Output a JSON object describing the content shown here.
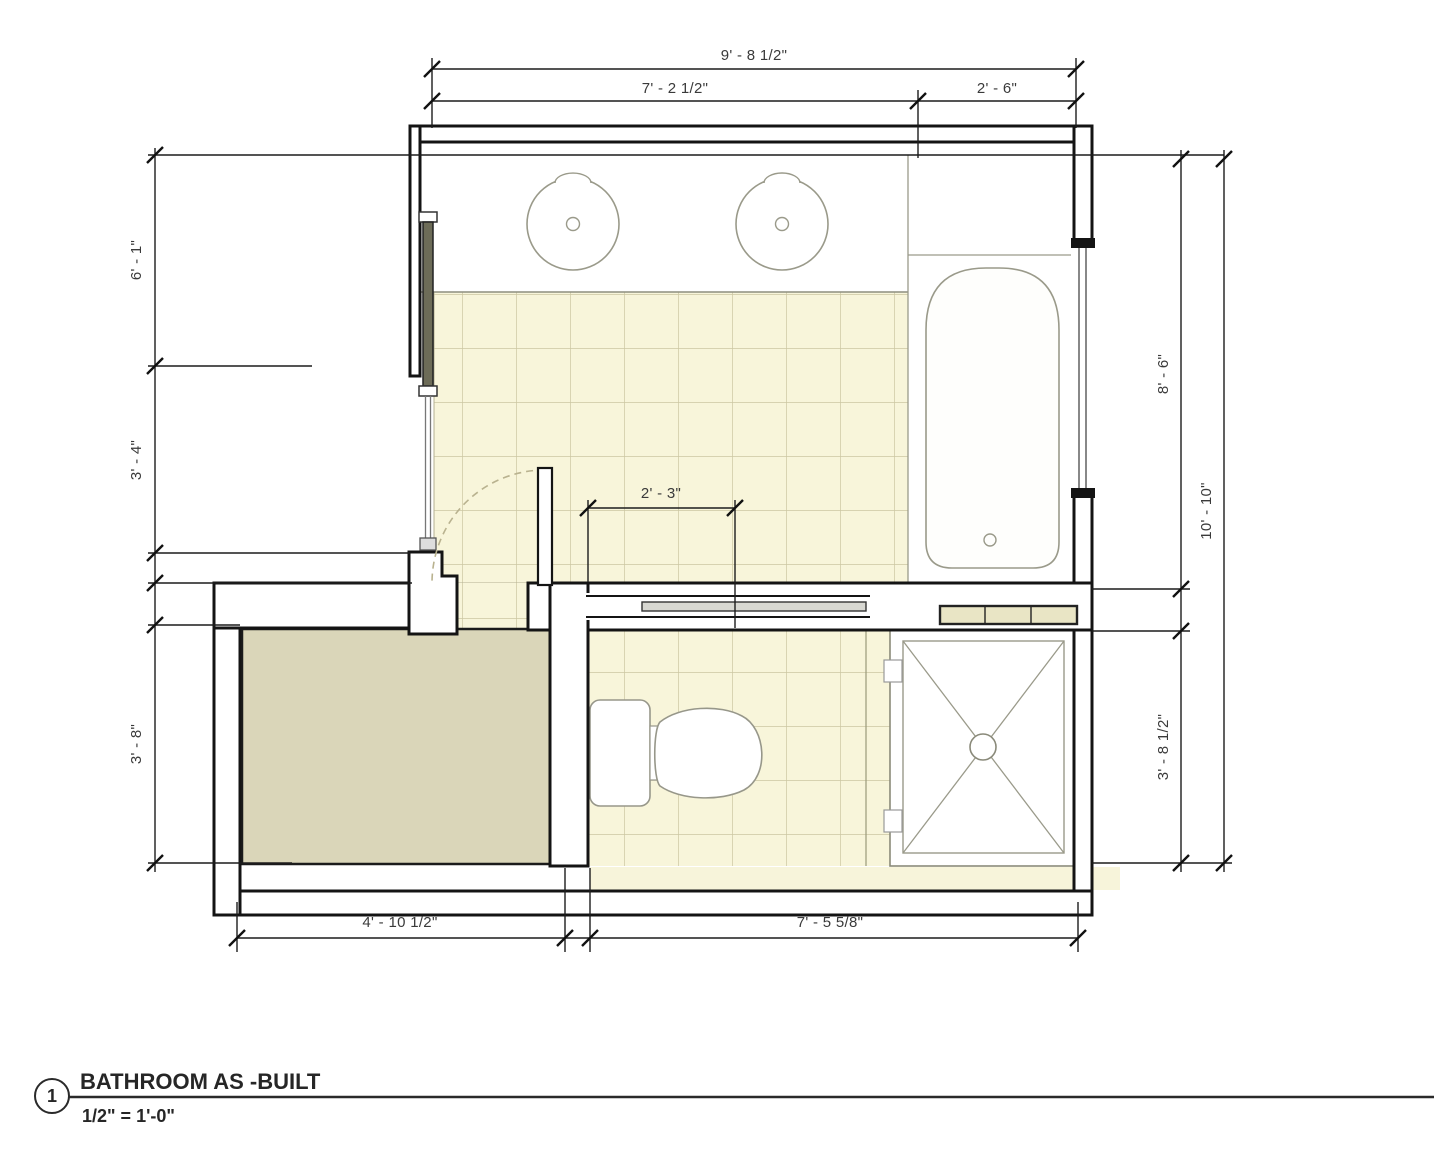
{
  "title_block": {
    "marker_number": "1",
    "title": "BATHROOM AS -BUILT",
    "scale": "1/2\" = 1'-0\""
  },
  "dimensions": {
    "top_overall": "9' - 8 1/2\"",
    "top_left_segment": "7' - 2 1/2\"",
    "top_right_segment": "2' - 6\"",
    "left_upper": "6' - 1\"",
    "left_middle": "3' - 4\"",
    "left_lower": "3' - 8\"",
    "right_tub_wall": "8' - 6\"",
    "right_overall": "10' - 10\"",
    "right_shower_wall": "3' - 8 1/2\"",
    "pocket_door_opening": "2' - 3\"",
    "bottom_left_segment": "4' - 10 1/2\"",
    "bottom_right_segment": "7' - 5 5/8\""
  },
  "colors": {
    "tile_floor": "#f8f5da",
    "tile_grid": "#ccc6a2",
    "closet_carpet": "#dad6b9",
    "wall_line": "#141414",
    "fixture_line": "#97978a",
    "shower_curb_fill": "#e9e5c5",
    "dimension_line": "#1c1c1c"
  }
}
